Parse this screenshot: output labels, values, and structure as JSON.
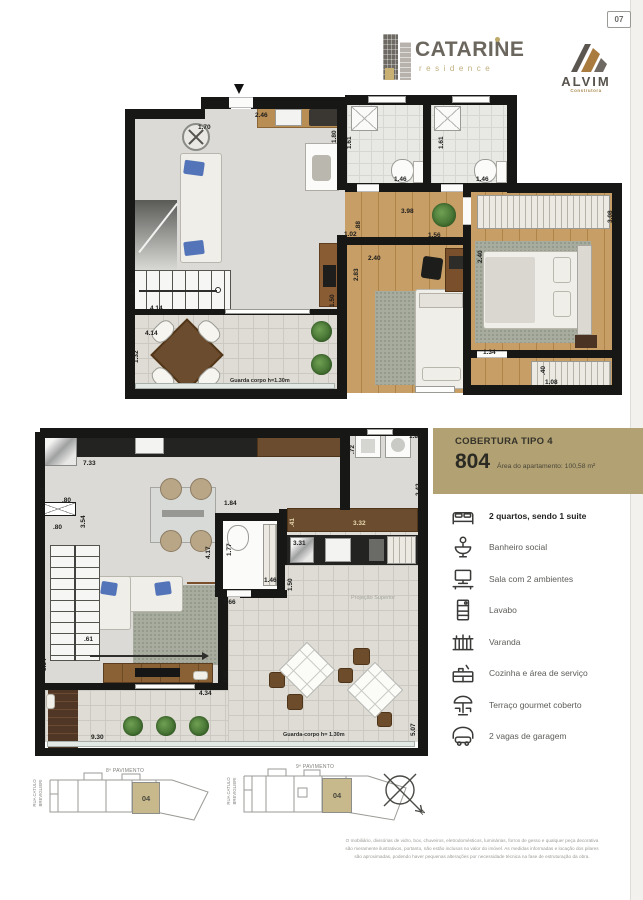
{
  "page": {
    "number": "07"
  },
  "colors": {
    "accent_gold": "#b1a173",
    "unit_highlight": "#c7b98c",
    "wall": "#171716",
    "wood_floor": "#c79e66",
    "counter_brown": "#6b4c2f"
  },
  "header": {
    "brand_name": "CATARINE",
    "brand_subtitle": "residence",
    "builder_name": "ALVIM",
    "builder_subtitle": "Construtora"
  },
  "info_panel": {
    "title": "COBERTURA TIPO 4",
    "unit_number": "804",
    "area_text": "Área do apartamento: 100,58 m²",
    "features": [
      {
        "icon": "bed-icon",
        "label": "2 quartos, sendo 1 suite",
        "emphasis": true
      },
      {
        "icon": "sink-icon",
        "label": "Banheiro social"
      },
      {
        "icon": "sofa-tv-icon",
        "label": "Sala com 2 ambientes"
      },
      {
        "icon": "toilet-icon",
        "label": "Lavabo"
      },
      {
        "icon": "balcony-icon",
        "label": "Varanda"
      },
      {
        "icon": "kitchen-icon",
        "label": "Cozinha e área de serviço"
      },
      {
        "icon": "umbrella-icon",
        "label": "Terraço gourmet coberto"
      },
      {
        "icon": "garage-icon",
        "label": "2 vagas de garagem"
      }
    ]
  },
  "upper_plan": {
    "labels": [
      {
        "t": "2.46",
        "x": 130,
        "y": 17
      },
      {
        "t": "1.70",
        "x": 73,
        "y": 29
      },
      {
        "t": "1.80",
        "x": 206,
        "y": 48,
        "o": "v"
      },
      {
        "t": "1.61",
        "x": 221,
        "y": 54,
        "o": "v"
      },
      {
        "t": "1.61",
        "x": 313,
        "y": 54,
        "o": "v"
      },
      {
        "t": "1.46",
        "x": 269,
        "y": 81
      },
      {
        "t": "1.46",
        "x": 351,
        "y": 81
      },
      {
        "t": "3.98",
        "x": 276,
        "y": 113
      },
      {
        "t": ".88",
        "x": 230,
        "y": 135,
        "o": "v"
      },
      {
        "t": "1.02",
        "x": 219,
        "y": 136
      },
      {
        "t": "1.56",
        "x": 303,
        "y": 137
      },
      {
        "t": "3.08",
        "x": 482,
        "y": 128,
        "o": "v"
      },
      {
        "t": "2.40",
        "x": 243,
        "y": 160
      },
      {
        "t": "2.83",
        "x": 228,
        "y": 186,
        "o": "v"
      },
      {
        "t": "2.40",
        "x": 352,
        "y": 168,
        "o": "v"
      },
      {
        "t": "1.50",
        "x": 204,
        "y": 212,
        "o": "v"
      },
      {
        "t": "3.86",
        "x": 4,
        "y": 200,
        "o": "v"
      },
      {
        "t": "4.14",
        "x": 25,
        "y": 210
      },
      {
        "t": "4.14",
        "x": 20,
        "y": 235
      },
      {
        "t": "1.32",
        "x": 8,
        "y": 268,
        "o": "v"
      },
      {
        "t": "1.34",
        "x": 358,
        "y": 254
      },
      {
        "t": ".40",
        "x": 415,
        "y": 280,
        "o": "v"
      },
      {
        "t": "1.08",
        "x": 420,
        "y": 284
      },
      {
        "t": "Guarda corpo h=1.30m",
        "x": 105,
        "y": 283,
        "s": "note"
      }
    ]
  },
  "lower_plan": {
    "labels": [
      {
        "t": "7.33",
        "x": 48,
        "y": 36
      },
      {
        "t": "1.82",
        "x": 4,
        "y": 76,
        "o": "v"
      },
      {
        "t": ".80",
        "x": 27,
        "y": 73
      },
      {
        "t": "3.54",
        "x": 45,
        "y": 104,
        "o": "v"
      },
      {
        "t": ".80",
        "x": 18,
        "y": 100
      },
      {
        "t": "1.84",
        "x": 189,
        "y": 76
      },
      {
        "t": "4.17",
        "x": 170,
        "y": 135,
        "o": "v"
      },
      {
        "t": "1.77",
        "x": 191,
        "y": 132,
        "o": "v"
      },
      {
        "t": "1.46",
        "x": 229,
        "y": 153
      },
      {
        "t": "1.66",
        "x": 188,
        "y": 175
      },
      {
        "t": ".72",
        "x": 314,
        "y": 30,
        "o": "v"
      },
      {
        "t": "1.80",
        "x": 374,
        "y": 9
      },
      {
        "t": "2.42",
        "x": 380,
        "y": 72,
        "o": "v"
      },
      {
        "t": "3.32",
        "x": 318,
        "y": 96,
        "s": "tan"
      },
      {
        "t": ".41",
        "x": 254,
        "y": 103,
        "o": "v",
        "s": "tan"
      },
      {
        "t": "3.31",
        "x": 258,
        "y": 116
      },
      {
        "t": "1.50",
        "x": 252,
        "y": 167,
        "o": "v"
      },
      {
        "t": ".61",
        "x": 49,
        "y": 212
      },
      {
        "t": "3.54",
        "x": 6,
        "y": 247,
        "o": "v"
      },
      {
        "t": "2.80",
        "x": 158,
        "y": 247,
        "s": "white"
      },
      {
        "t": "2.25",
        "x": 188,
        "y": 259,
        "o": "v"
      },
      {
        "t": "4.34",
        "x": 164,
        "y": 266
      },
      {
        "t": "1.32",
        "x": 11,
        "y": 285,
        "o": "v",
        "s": "white"
      },
      {
        "t": "9.30",
        "x": 56,
        "y": 310
      },
      {
        "t": "5.07",
        "x": 375,
        "y": 312,
        "o": "v"
      },
      {
        "t": "Projeção Superior",
        "x": 316,
        "y": 171,
        "s": "grey"
      },
      {
        "t": "Guarda-corpo h= 1.30m",
        "x": 248,
        "y": 308,
        "s": "note"
      }
    ]
  },
  "floor_keys": [
    {
      "street_line1": "RUA CATULO",
      "street_line2": "BREVIGLIERI",
      "floor_label": "8º PAVIMENTO",
      "unit": "04"
    },
    {
      "street_line1": "RUA CATULO",
      "street_line2": "BREVIGLIERI",
      "floor_label": "9º PAVIMENTO",
      "unit": "04"
    }
  ],
  "compass": {
    "north_label": "N"
  },
  "disclaimer": {
    "lines": [
      "O mobiliário, divisórias de vidro, box, chuveiros, eletrodomésticos, luminárias, forros de gesso e qualquer peça decorativa",
      "são meramente ilustrativos, portanto, não estão inclusos no valor do imóvel. As medidas informadas e locação dos pilares",
      "são aproximadas, podendo haver pequenas alterações por necessidade técnica na fase de estruturação da obra."
    ]
  }
}
